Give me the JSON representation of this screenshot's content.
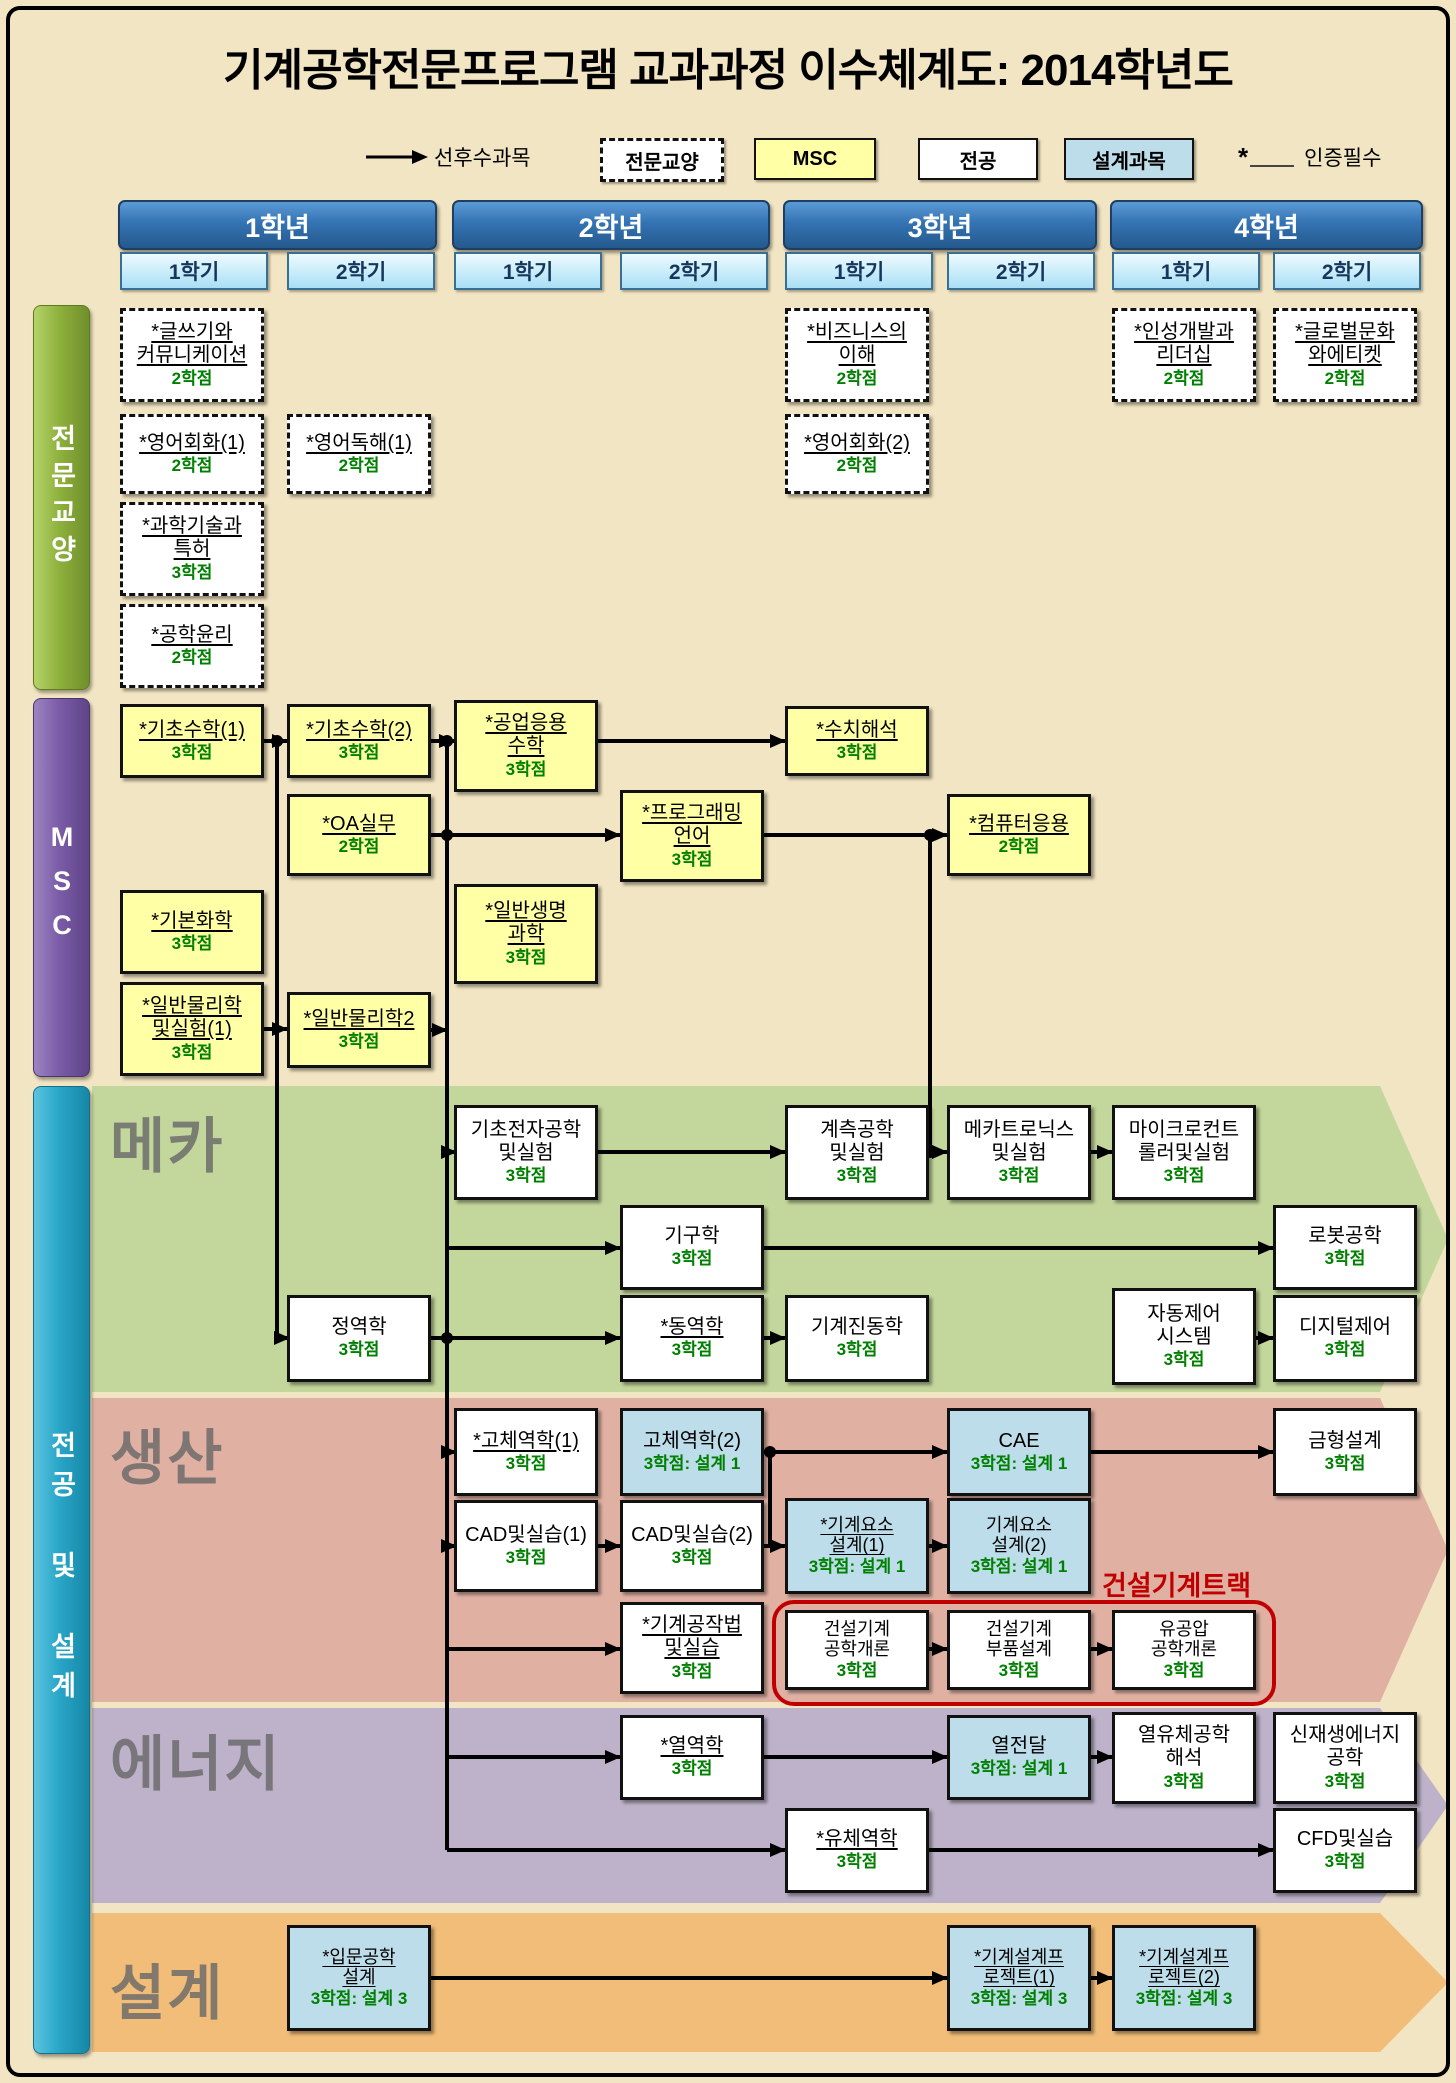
{
  "title": "기계공학전문프로그램 교과과정 이수체계도: 2014학년도",
  "legend": {
    "arrow_label": "선후수과목",
    "items": [
      {
        "key": "liberal",
        "label": "전문교양"
      },
      {
        "key": "msc",
        "label": "MSC"
      },
      {
        "key": "major",
        "label": "전공"
      },
      {
        "key": "design",
        "label": "설계과목"
      }
    ],
    "star": "*",
    "cert_label": "인증필수"
  },
  "years": [
    {
      "label": "1학년",
      "semesters": [
        "1학기",
        "2학기"
      ]
    },
    {
      "label": "2학년",
      "semesters": [
        "1학기",
        "2학기"
      ]
    },
    {
      "label": "3학년",
      "semesters": [
        "1학기",
        "2학기"
      ]
    },
    {
      "label": "4학년",
      "semesters": [
        "1학기",
        "2학기"
      ]
    }
  ],
  "sidebars": [
    {
      "key": "liberal",
      "label": "전문교양",
      "y": 305,
      "h": 383
    },
    {
      "key": "msc",
      "label": "MSC",
      "y": 698,
      "h": 377
    },
    {
      "key": "major",
      "label": "전공 및 설계",
      "y": 1086,
      "h": 966
    }
  ],
  "bands": [
    {
      "key": "mecha",
      "label": "메카",
      "color": "#c3d69b",
      "y": 1086,
      "h": 306,
      "label_dy": 12
    },
    {
      "key": "production",
      "label": "생산",
      "color": "#e0b1a3",
      "y": 1398,
      "h": 304,
      "label_dy": 12
    },
    {
      "key": "energy",
      "label": "에너지",
      "color": "#bdb2c9",
      "y": 1708,
      "h": 195,
      "label_dy": 8
    },
    {
      "key": "design",
      "label": "설계",
      "color": "#f1bd78",
      "y": 1913,
      "h": 139,
      "label_dy": 32
    }
  ],
  "track": {
    "label": "건설기계트랙",
    "label_x": 1102,
    "label_y": 1564,
    "x": 772,
    "y": 1600,
    "w": 496,
    "h": 98
  },
  "layout": {
    "canvas_w": 1456,
    "canvas_h": 2083,
    "columns": [
      120,
      287,
      454,
      620,
      785,
      947,
      1112,
      1273
    ],
    "col_w": 144,
    "years_x": [
      [
        118,
        315
      ],
      [
        452,
        314
      ],
      [
        783,
        310
      ],
      [
        1110,
        309
      ]
    ],
    "header_y": 200,
    "header_h": 46,
    "sem_y": 252,
    "sem_h": 34,
    "sidebar_x": 33,
    "sidebar_w": 55
  },
  "courses": [
    {
      "id": "writing-communication",
      "type": "liberal",
      "col": 1,
      "y": 308,
      "h": 94,
      "lines": [
        "*글쓰기와",
        "커뮤니케이션"
      ],
      "credit": "2학점",
      "u": true
    },
    {
      "id": "business-understanding",
      "type": "liberal",
      "col": 5,
      "y": 308,
      "h": 94,
      "lines": [
        "*비즈니스의",
        "이해"
      ],
      "credit": "2학점",
      "u": true
    },
    {
      "id": "personality-leadership",
      "type": "liberal",
      "col": 7,
      "y": 308,
      "h": 94,
      "lines": [
        "*인성개발과",
        "리더십"
      ],
      "credit": "2학점",
      "u": true
    },
    {
      "id": "global-culture-etiquette",
      "type": "liberal",
      "col": 8,
      "y": 308,
      "h": 94,
      "lines": [
        "*글로벌문화",
        "와에티켓"
      ],
      "credit": "2학점",
      "u": true
    },
    {
      "id": "english-conversation-1",
      "type": "liberal",
      "col": 1,
      "y": 414,
      "h": 80,
      "lines": [
        "*영어회화(1)"
      ],
      "credit": "2학점",
      "u": true
    },
    {
      "id": "english-reading-1",
      "type": "liberal",
      "col": 2,
      "y": 414,
      "h": 80,
      "lines": [
        "*영어독해(1)"
      ],
      "credit": "2학점",
      "u": true
    },
    {
      "id": "english-conversation-2",
      "type": "liberal",
      "col": 5,
      "y": 414,
      "h": 80,
      "lines": [
        "*영어회화(2)"
      ],
      "credit": "2학점",
      "u": true
    },
    {
      "id": "science-tech-patent",
      "type": "liberal",
      "col": 1,
      "y": 502,
      "h": 94,
      "lines": [
        "*과학기술과",
        "특허"
      ],
      "credit": "3학점",
      "u": true
    },
    {
      "id": "engineering-ethics",
      "type": "liberal",
      "col": 1,
      "y": 604,
      "h": 84,
      "lines": [
        "*공학윤리"
      ],
      "credit": "2학점",
      "u": true
    },
    {
      "id": "basic-math-1",
      "type": "msc",
      "col": 1,
      "y": 704,
      "h": 74,
      "lines": [
        "*기초수학(1)"
      ],
      "credit": "3학점",
      "u": true
    },
    {
      "id": "basic-math-2",
      "type": "msc",
      "col": 2,
      "y": 704,
      "h": 74,
      "lines": [
        "*기초수학(2)"
      ],
      "credit": "3학점",
      "u": true
    },
    {
      "id": "engineering-applied-math",
      "type": "msc",
      "col": 3,
      "y": 700,
      "h": 92,
      "lines": [
        "*공업응용",
        "수학"
      ],
      "credit": "3학점",
      "u": true
    },
    {
      "id": "numerical-analysis",
      "type": "msc",
      "col": 5,
      "y": 706,
      "h": 70,
      "lines": [
        "*수치해석"
      ],
      "credit": "3학점",
      "u": true
    },
    {
      "id": "oa-practice",
      "type": "msc",
      "col": 2,
      "y": 794,
      "h": 82,
      "lines": [
        "*OA실무"
      ],
      "credit": "2학점",
      "u": true
    },
    {
      "id": "programming-language",
      "type": "msc",
      "col": 4,
      "y": 790,
      "h": 92,
      "lines": [
        "*프로그래밍",
        "언어"
      ],
      "credit": "3학점",
      "u": true
    },
    {
      "id": "computer-application",
      "type": "msc",
      "col": 6,
      "y": 794,
      "h": 82,
      "lines": [
        "*컴퓨터응용"
      ],
      "credit": "2학점",
      "u": true
    },
    {
      "id": "basic-chemistry",
      "type": "msc",
      "col": 1,
      "y": 890,
      "h": 84,
      "lines": [
        "*기본화학"
      ],
      "credit": "3학점",
      "u": true
    },
    {
      "id": "general-life-science",
      "type": "msc",
      "col": 3,
      "y": 884,
      "h": 100,
      "lines": [
        "*일반생명",
        "과학"
      ],
      "credit": "3학점",
      "u": true
    },
    {
      "id": "general-physics-lab-1",
      "type": "msc",
      "col": 1,
      "y": 982,
      "h": 94,
      "lines": [
        "*일반물리학",
        "및실험(1)"
      ],
      "credit": "3학점",
      "u": true
    },
    {
      "id": "general-physics-2",
      "type": "msc",
      "col": 2,
      "y": 992,
      "h": 76,
      "lines": [
        "*일반물리학2"
      ],
      "credit": "3학점",
      "u": true
    },
    {
      "id": "basic-electronics-lab",
      "type": "major",
      "col": 3,
      "y": 1105,
      "h": 95,
      "lines": [
        "기초전자공학",
        "및실험"
      ],
      "credit": "3학점",
      "u": false
    },
    {
      "id": "instrumentation-lab",
      "type": "major",
      "col": 5,
      "y": 1105,
      "h": 95,
      "lines": [
        "계측공학",
        "및실험"
      ],
      "credit": "3학점",
      "u": false
    },
    {
      "id": "mechatronics-lab",
      "type": "major",
      "col": 6,
      "y": 1105,
      "h": 95,
      "lines": [
        "메카트로닉스",
        "및실험"
      ],
      "credit": "3학점",
      "u": false
    },
    {
      "id": "microcontroller-lab",
      "type": "major",
      "col": 7,
      "y": 1105,
      "h": 95,
      "lines": [
        "마이크로컨트",
        "롤러및실험"
      ],
      "credit": "3학점",
      "u": false
    },
    {
      "id": "kinematics",
      "type": "major",
      "col": 4,
      "y": 1205,
      "h": 85,
      "lines": [
        "기구학"
      ],
      "credit": "3학점",
      "u": false
    },
    {
      "id": "robotics",
      "type": "major",
      "col": 8,
      "y": 1205,
      "h": 85,
      "lines": [
        "로봇공학"
      ],
      "credit": "3학점",
      "u": false
    },
    {
      "id": "statics",
      "type": "major",
      "col": 2,
      "y": 1295,
      "h": 87,
      "lines": [
        "정역학"
      ],
      "credit": "3학점",
      "u": false
    },
    {
      "id": "dynamics",
      "type": "major",
      "col": 4,
      "y": 1295,
      "h": 87,
      "lines": [
        "*동역학"
      ],
      "credit": "3학점",
      "u": true
    },
    {
      "id": "mechanical-vibration",
      "type": "major",
      "col": 5,
      "y": 1295,
      "h": 87,
      "lines": [
        "기계진동학"
      ],
      "credit": "3학점",
      "u": false
    },
    {
      "id": "automatic-control-system",
      "type": "major",
      "col": 7,
      "y": 1288,
      "h": 97,
      "lines": [
        "자동제어",
        "시스템"
      ],
      "credit": "3학점",
      "u": false
    },
    {
      "id": "digital-control",
      "type": "major",
      "col": 8,
      "y": 1295,
      "h": 87,
      "lines": [
        "디지털제어"
      ],
      "credit": "3학점",
      "u": false
    },
    {
      "id": "solid-mechanics-1",
      "type": "major",
      "col": 3,
      "y": 1408,
      "h": 88,
      "lines": [
        "*고체역학(1)"
      ],
      "credit": "3학점",
      "u": true
    },
    {
      "id": "solid-mechanics-2",
      "type": "design",
      "col": 4,
      "y": 1408,
      "h": 88,
      "lines": [
        "고체역학(2)"
      ],
      "credit": "3학점: 설계 1",
      "u": false
    },
    {
      "id": "cae",
      "type": "design",
      "col": 6,
      "y": 1408,
      "h": 88,
      "lines": [
        "CAE"
      ],
      "credit": "3학점: 설계 1",
      "u": false
    },
    {
      "id": "mold-design",
      "type": "major",
      "col": 8,
      "y": 1408,
      "h": 88,
      "lines": [
        "금형설계"
      ],
      "credit": "3학점",
      "u": false
    },
    {
      "id": "cad-practice-1",
      "type": "major",
      "col": 3,
      "y": 1500,
      "h": 92,
      "lines": [
        "CAD및실습(1)"
      ],
      "credit": "3학점",
      "u": false
    },
    {
      "id": "cad-practice-2",
      "type": "major",
      "col": 4,
      "y": 1500,
      "h": 92,
      "lines": [
        "CAD및실습(2)"
      ],
      "credit": "3학점",
      "u": false
    },
    {
      "id": "machine-element-design-1",
      "type": "design small",
      "col": 5,
      "y": 1498,
      "h": 96,
      "lines": [
        "*기계요소",
        "설계(1)"
      ],
      "credit": "3학점: 설계 1",
      "u": true
    },
    {
      "id": "machine-element-design-2",
      "type": "design small",
      "col": 6,
      "y": 1498,
      "h": 96,
      "lines": [
        "기계요소",
        "설계(2)"
      ],
      "credit": "3학점: 설계 1",
      "u": false
    },
    {
      "id": "manufacturing-practice",
      "type": "major",
      "col": 4,
      "y": 1602,
      "h": 92,
      "lines": [
        "*기계공작법",
        "및실습"
      ],
      "credit": "3학점",
      "u": true
    },
    {
      "id": "construction-machinery-intro",
      "type": "major small",
      "col": 5,
      "y": 1610,
      "h": 80,
      "lines": [
        "건설기계",
        "공학개론"
      ],
      "credit": "3학점",
      "u": false
    },
    {
      "id": "construction-machinery-parts",
      "type": "major small",
      "col": 6,
      "y": 1610,
      "h": 80,
      "lines": [
        "건설기계",
        "부품설계"
      ],
      "credit": "3학점",
      "u": false
    },
    {
      "id": "hydraulics-pneumatics",
      "type": "major small",
      "col": 7,
      "y": 1610,
      "h": 80,
      "lines": [
        "유공압",
        "공학개론"
      ],
      "credit": "3학점",
      "u": false
    },
    {
      "id": "thermodynamics",
      "type": "major",
      "col": 4,
      "y": 1715,
      "h": 85,
      "lines": [
        "*열역학"
      ],
      "credit": "3학점",
      "u": true
    },
    {
      "id": "heat-transfer",
      "type": "design",
      "col": 6,
      "y": 1715,
      "h": 85,
      "lines": [
        "열전달"
      ],
      "credit": "3학점: 설계 1",
      "u": false
    },
    {
      "id": "thermofluid-analysis",
      "type": "major",
      "col": 7,
      "y": 1712,
      "h": 92,
      "lines": [
        "열유체공학",
        "해석"
      ],
      "credit": "3학점",
      "u": false
    },
    {
      "id": "renewable-energy",
      "type": "major",
      "col": 8,
      "y": 1712,
      "h": 92,
      "lines": [
        "신재생에너지",
        "공학"
      ],
      "credit": "3학점",
      "u": false
    },
    {
      "id": "fluid-mechanics",
      "type": "major",
      "col": 5,
      "y": 1808,
      "h": 85,
      "lines": [
        "*유체역학"
      ],
      "credit": "3학점",
      "u": true
    },
    {
      "id": "cfd-practice",
      "type": "major",
      "col": 8,
      "y": 1808,
      "h": 85,
      "lines": [
        "CFD및실습"
      ],
      "credit": "3학점",
      "u": false
    },
    {
      "id": "intro-engineering-design",
      "type": "design small",
      "col": 2,
      "y": 1925,
      "h": 106,
      "lines": [
        "*입문공학",
        "설계"
      ],
      "credit": "3학점: 설계 3",
      "u": true
    },
    {
      "id": "design-project-1",
      "type": "design small",
      "col": 6,
      "y": 1925,
      "h": 106,
      "lines": [
        "*기계설계프",
        "로젝트(1)"
      ],
      "credit": "3학점: 설계 3",
      "u": true
    },
    {
      "id": "design-project-2",
      "type": "design small",
      "col": 7,
      "y": 1925,
      "h": 106,
      "lines": [
        "*기계설계프",
        "로젝트(2)"
      ],
      "credit": "3학점: 설계 3",
      "u": true
    }
  ],
  "arrows": [
    {
      "points": [
        [
          264,
          741
        ],
        [
          287,
          741
        ]
      ],
      "head": true
    },
    {
      "points": [
        [
          431,
          741
        ],
        [
          454,
          741
        ]
      ],
      "head": true
    },
    {
      "points": [
        [
          598,
          741
        ],
        [
          785,
          741
        ]
      ],
      "head": true
    },
    {
      "points": [
        [
          431,
          835
        ],
        [
          620,
          835
        ]
      ],
      "head": true
    },
    {
      "points": [
        [
          764,
          835
        ],
        [
          947,
          835
        ]
      ],
      "head": true
    },
    {
      "points": [
        [
          264,
          1029
        ],
        [
          287,
          1029
        ]
      ],
      "head": true
    },
    {
      "points": [
        [
          431,
          1030
        ],
        [
          447,
          1030
        ]
      ],
      "head": true
    },
    {
      "points": [
        [
          277,
          741
        ],
        [
          277,
          1338
        ],
        [
          289,
          1338
        ]
      ],
      "head": true
    },
    {
      "points": [
        [
          447,
          741
        ],
        [
          447,
          1850
        ]
      ],
      "head": false
    },
    {
      "points": [
        [
          447,
          1152
        ],
        [
          456,
          1152
        ]
      ],
      "head": true
    },
    {
      "points": [
        [
          447,
          1248
        ],
        [
          620,
          1248
        ]
      ],
      "head": true
    },
    {
      "points": [
        [
          447,
          1452
        ],
        [
          456,
          1452
        ]
      ],
      "head": true
    },
    {
      "points": [
        [
          447,
          1546
        ],
        [
          456,
          1546
        ]
      ],
      "head": true
    },
    {
      "points": [
        [
          447,
          1649
        ],
        [
          620,
          1649
        ]
      ],
      "head": true
    },
    {
      "points": [
        [
          447,
          1757
        ],
        [
          620,
          1757
        ]
      ],
      "head": true
    },
    {
      "points": [
        [
          447,
          1850
        ],
        [
          785,
          1850
        ]
      ],
      "head": true
    },
    {
      "points": [
        [
          598,
          1152
        ],
        [
          785,
          1152
        ]
      ],
      "head": true
    },
    {
      "points": [
        [
          929,
          1152
        ],
        [
          947,
          1152
        ]
      ],
      "head": true
    },
    {
      "points": [
        [
          1091,
          1152
        ],
        [
          1112,
          1152
        ]
      ],
      "head": true
    },
    {
      "points": [
        [
          764,
          1248
        ],
        [
          1273,
          1248
        ]
      ],
      "head": true
    },
    {
      "points": [
        [
          431,
          1338
        ],
        [
          620,
          1338
        ]
      ],
      "head": true
    },
    {
      "points": [
        [
          764,
          1338
        ],
        [
          785,
          1338
        ]
      ],
      "head": true
    },
    {
      "points": [
        [
          1256,
          1338
        ],
        [
          1273,
          1338
        ]
      ],
      "head": true
    },
    {
      "points": [
        [
          930,
          835
        ],
        [
          930,
          1152
        ]
      ],
      "head": false
    },
    {
      "points": [
        [
          764,
          1452
        ],
        [
          947,
          1452
        ]
      ],
      "head": true
    },
    {
      "points": [
        [
          770,
          1452
        ],
        [
          770,
          1546
        ]
      ],
      "head": false
    },
    {
      "points": [
        [
          764,
          1546
        ],
        [
          785,
          1546
        ]
      ],
      "head": true
    },
    {
      "points": [
        [
          598,
          1546
        ],
        [
          620,
          1546
        ]
      ],
      "head": true
    },
    {
      "points": [
        [
          929,
          1546
        ],
        [
          947,
          1546
        ]
      ],
      "head": true
    },
    {
      "points": [
        [
          1091,
          1452
        ],
        [
          1273,
          1452
        ]
      ],
      "head": true
    },
    {
      "points": [
        [
          929,
          1649
        ],
        [
          947,
          1649
        ]
      ],
      "head": true
    },
    {
      "points": [
        [
          1091,
          1649
        ],
        [
          1112,
          1649
        ]
      ],
      "head": true
    },
    {
      "points": [
        [
          764,
          1757
        ],
        [
          947,
          1757
        ]
      ],
      "head": true
    },
    {
      "points": [
        [
          1091,
          1757
        ],
        [
          1112,
          1757
        ]
      ],
      "head": true
    },
    {
      "points": [
        [
          929,
          1850
        ],
        [
          1273,
          1850
        ]
      ],
      "head": true
    },
    {
      "points": [
        [
          431,
          1978
        ],
        [
          947,
          1978
        ]
      ],
      "head": true
    },
    {
      "points": [
        [
          1091,
          1978
        ],
        [
          1112,
          1978
        ]
      ],
      "head": true
    }
  ],
  "dots": [
    [
      277,
      741
    ],
    [
      447,
      741
    ],
    [
      447,
      835
    ],
    [
      447,
      1338
    ],
    [
      930,
      835
    ],
    [
      930,
      1152
    ],
    [
      770,
      1452
    ]
  ]
}
